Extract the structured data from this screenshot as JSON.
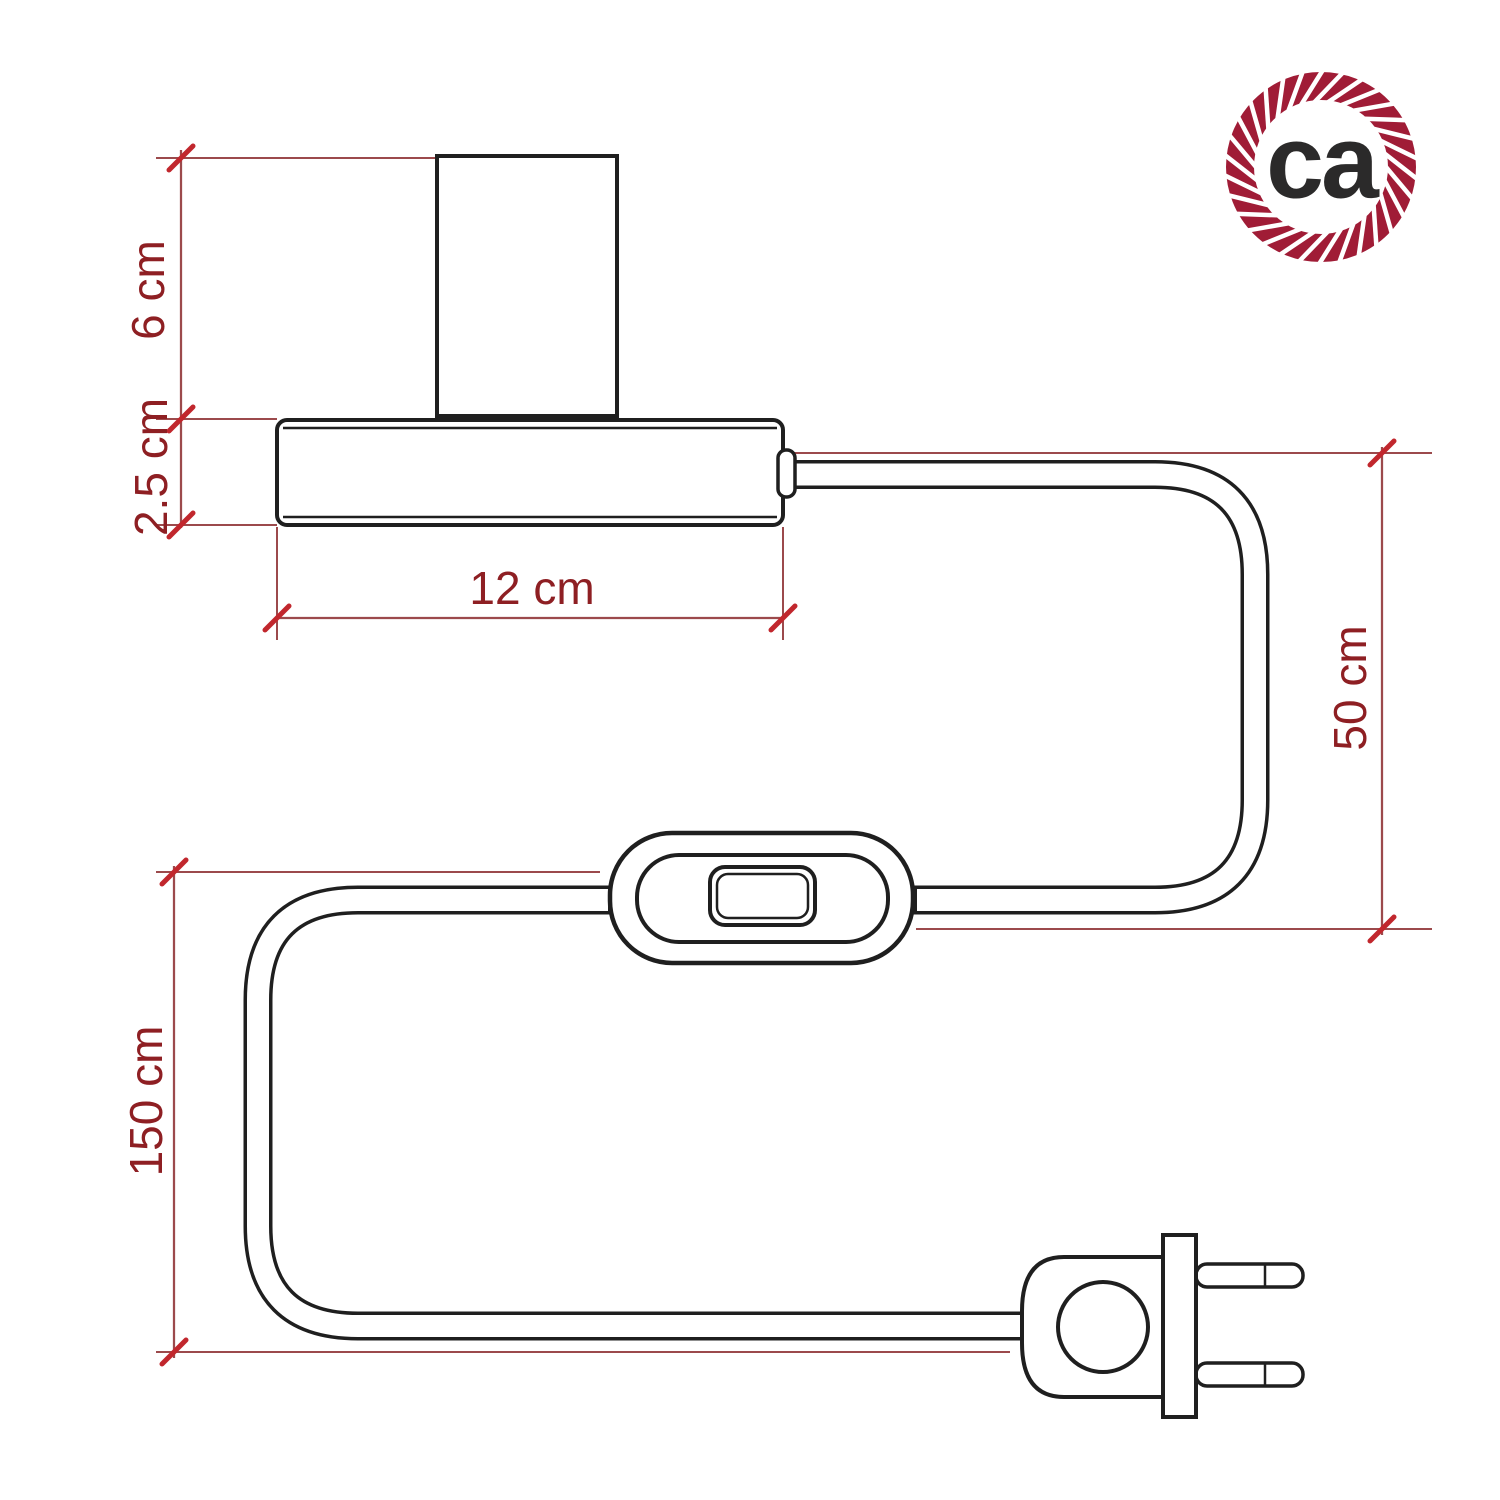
{
  "diagram": {
    "title": "table-lamp-with-inline-switch-and-plug-dimension-drawing",
    "dimensions": {
      "socket_height": "6 cm",
      "base_height": "2.5 cm",
      "base_width": "12 cm",
      "lamp_to_switch_cable": "50 cm",
      "total_cable_length": "150 cm"
    },
    "logo": {
      "text": "ca",
      "ring_color": "#a01c36",
      "text_color": "#2b2a2a"
    },
    "colors": {
      "drawing_line": "#1f1f1f",
      "dimension_line": "#9c4a4c",
      "tick_mark": "#c1272d",
      "dimension_text": "#8e1f23",
      "background": "#ffffff"
    }
  }
}
